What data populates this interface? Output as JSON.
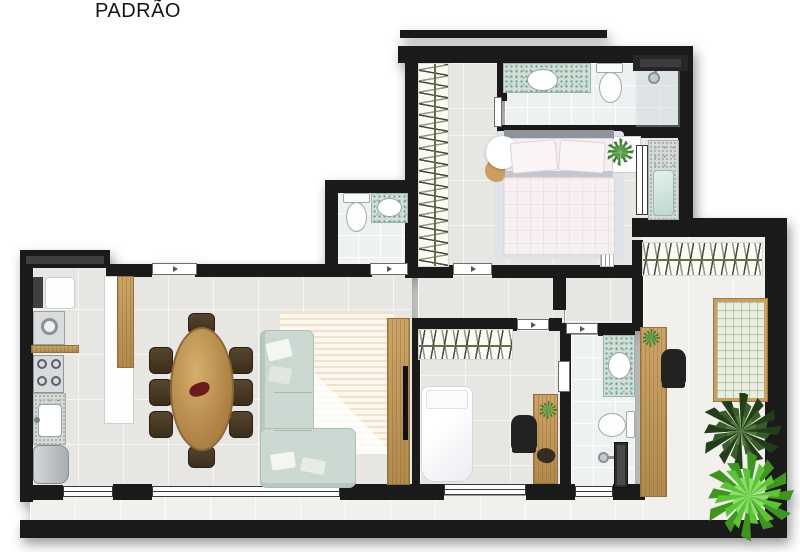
{
  "title": "PADRÃO",
  "palette": {
    "wall": "#1a1a1a",
    "floor": "#e8e6e2",
    "wet_floor": "#eef1f2",
    "balcony_floor": "#f1f0ec",
    "wood": "#c49a5c",
    "mosaic": "#cfe0d8",
    "mosaic_dot": "#78998b",
    "granite": "#d6dad7",
    "glass": "#cfe6df",
    "sofa": "#ccd9d2",
    "bed_rug": "#dde3e8",
    "bed_linen": "#f6eff2",
    "quilt": "#e7eedd",
    "dining_chair": "#4b3a26",
    "rail_line": "#6b6b45",
    "palm_green": "#2c4a22",
    "fern_green": "#55bb2f",
    "appliance": "#c3c7ca"
  },
  "counts": {
    "dining_chairs": 8,
    "beds": 2,
    "bathrooms": 3,
    "office_chairs": 2,
    "plants": 5,
    "wardrobe_rails": 3
  },
  "inventory": {
    "suite_bathroom": [
      "mosaic-vanity-sink",
      "toilet",
      "shower-head",
      "dark-niche"
    ],
    "suite_bedroom": [
      "double-bed",
      "pillows",
      "side-table-plant",
      "round-rugs",
      "closet-rail",
      "glass-tub-granite"
    ],
    "lavabo": [
      "toilet",
      "mosaic-vanity-sink"
    ],
    "kitchen": [
      "laundry-tank",
      "washer",
      "wood-shelf",
      "cooktop",
      "granite-counter-sink",
      "fridge",
      "island"
    ],
    "dining": [
      "oval-wood-table",
      "centerpiece"
    ],
    "living": [
      "l-shaped-sofa",
      "striped-rug",
      "tv-panel",
      "tv"
    ],
    "office_room": [
      "wardrobe-rail",
      "single-bed",
      "wood-desk",
      "office-chair",
      "desk-plant"
    ],
    "bathroom_2": [
      "mosaic-vanity-sink",
      "toilet",
      "shower-screen"
    ],
    "right_balcony": [
      "slatted-bench",
      "wood-counter",
      "office-chair",
      "counter-plant",
      "quilted-futon",
      "palm-tree",
      "fern"
    ]
  }
}
